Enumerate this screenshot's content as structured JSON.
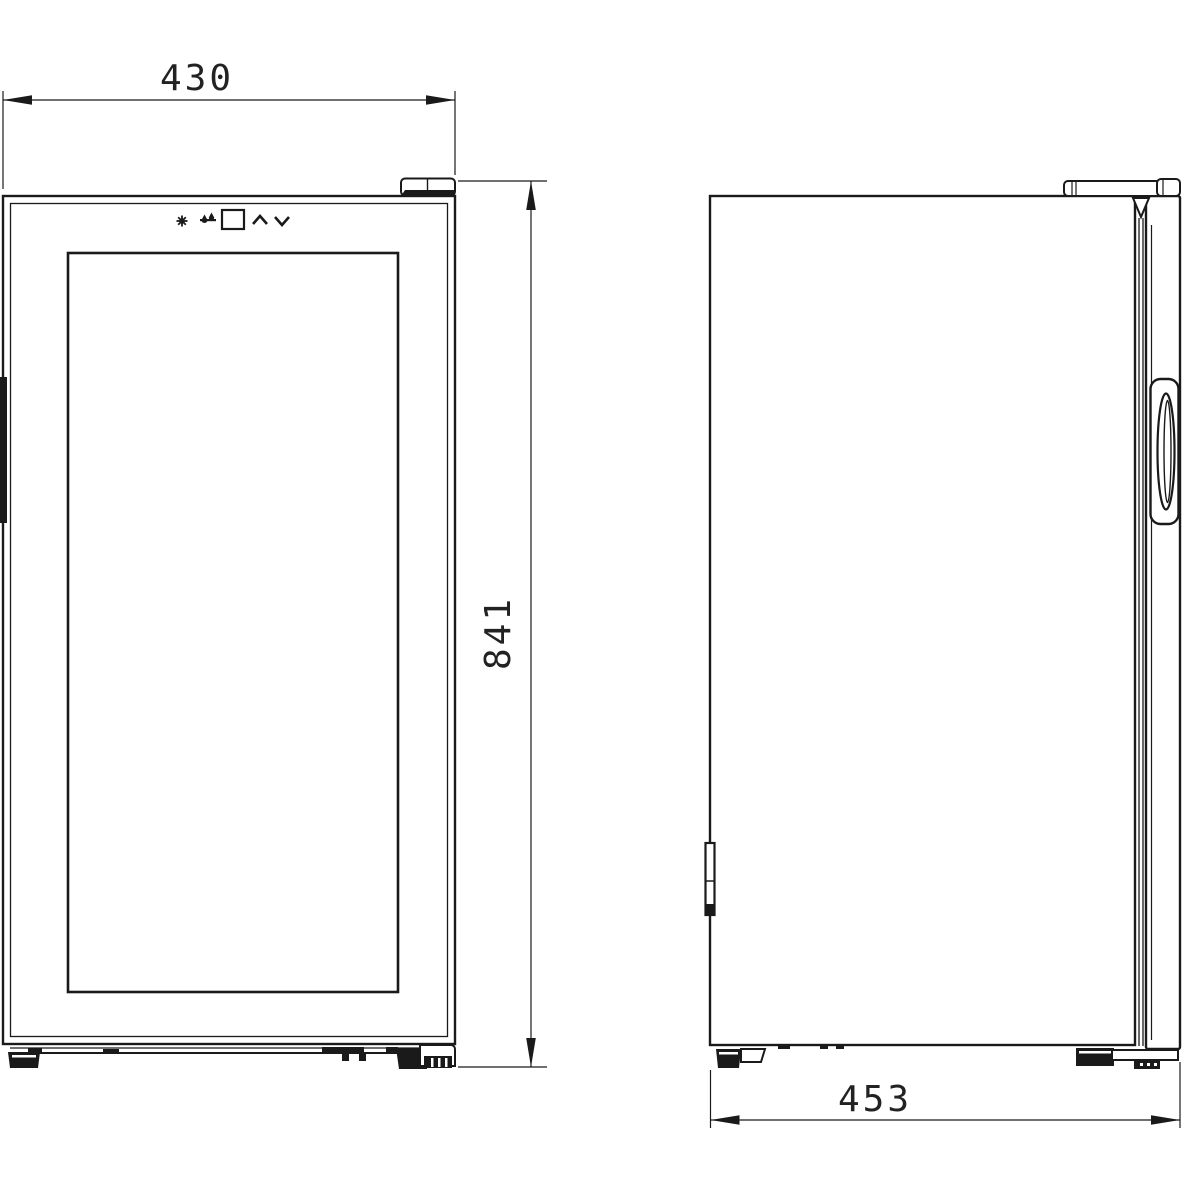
{
  "drawing": {
    "background_color": "#ffffff",
    "line_color": "#1a1a1a",
    "dimensions": {
      "width_mm": "430",
      "height_mm": "841",
      "depth_mm": "453"
    },
    "control_panel_icons": [
      "power-light-icon",
      "drops-icon",
      "display-window",
      "chevron-up-icon",
      "chevron-down-icon"
    ],
    "views": {
      "front": "front-elevation",
      "side": "side-elevation"
    }
  }
}
